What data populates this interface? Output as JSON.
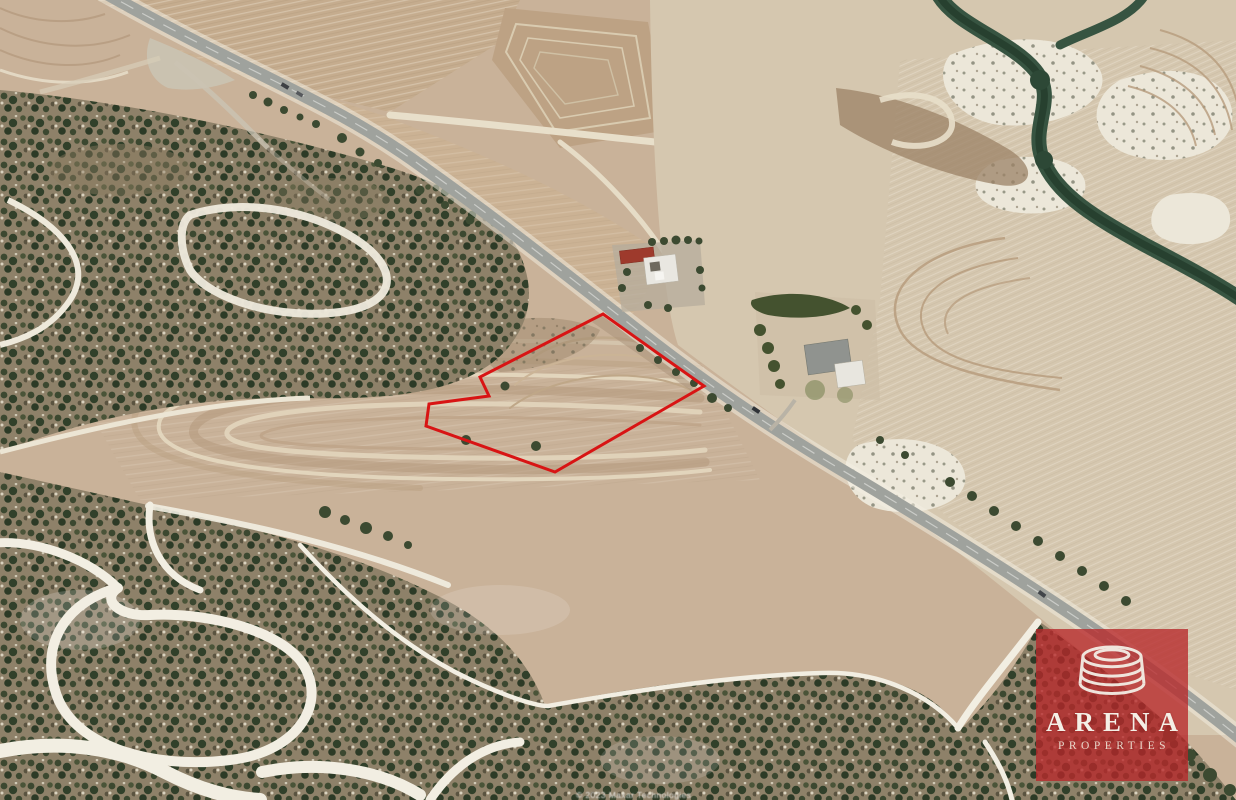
{
  "watermark": {
    "brand": "ARENA",
    "tagline": "PROPERTIES",
    "icon": "arena-rings-icon",
    "background_color": "#b72a2a",
    "text_color": "#f2ece1"
  },
  "plot_overlay": {
    "outline_color": "#d81414",
    "stroke_width": "3",
    "points": "603,314 656,352 704,386 555,472 426,426 429,404 489,396 480,377"
  },
  "attribution": {
    "text": "© 2023 Maxar Technologies"
  },
  "scene": {
    "type": "satellite aerial photograph",
    "description": "Cyprus farmland: diagonal rural highway from top-left to bottom-right, plowed tan fields above and right of the road, dark green scrubland with winding white dirt tracks on the left and bottom, two farm compounds near the road, terraced field contours, and a red outline marking the land plot for sale",
    "palette": {
      "field_tan": "#c9b299",
      "field_cream": "#d6c8b1",
      "scrub_dark": "#3c4830",
      "scrub_ground": "#8e8169",
      "track_white": "#f2eee2",
      "road_gray": "#9fa29d",
      "creek_green": "#375441",
      "roof_red": "#9e3a2c",
      "roof_gray": "#90938f"
    }
  }
}
